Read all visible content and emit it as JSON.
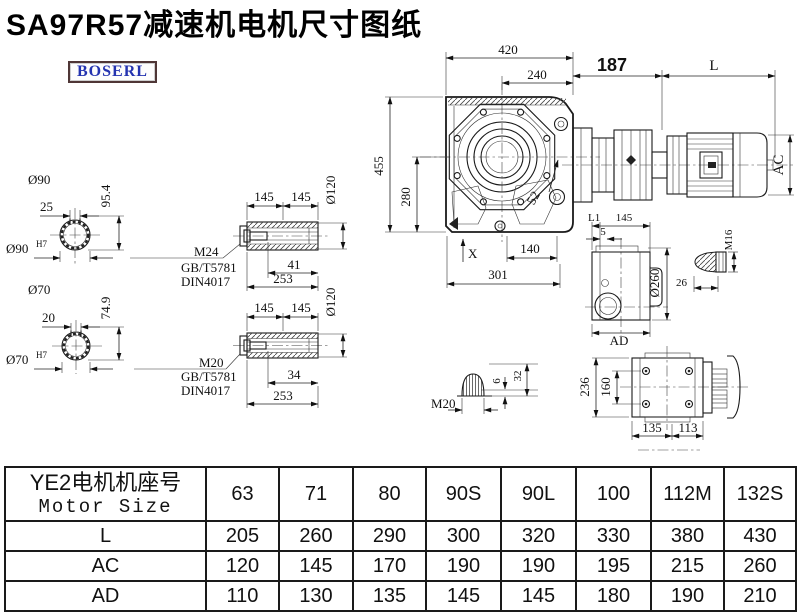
{
  "title": "SA97R57减速机电机尺寸图纸",
  "brand": {
    "logo_text": "BOSERL"
  },
  "colors": {
    "title_text": "#000000",
    "logo_text": "#2433b0",
    "logo_border": "#4f3636",
    "line": "#1a1a1a",
    "background": "#ffffff",
    "table_border": "#1a1a1a"
  },
  "drawing": {
    "front_view": {
      "width_top": "420",
      "width_flange": "240",
      "gear_to_motor": "187",
      "motor_length": "L",
      "height_total": "455",
      "height_center": "280",
      "bolt_offset": "52",
      "foot_width": "140",
      "base_width": "301",
      "oil_mark": "X",
      "motor_diameter": "AC"
    },
    "shaft_upper": {
      "label": "Ø90",
      "key_width": "25",
      "key_height": "95.4",
      "bore": "Ø90",
      "bore_fit": "H7"
    },
    "shaft_lower": {
      "label": "Ø70",
      "key_width": "20",
      "key_height": "74.9",
      "bore": "Ø70",
      "bore_fit": "H7"
    },
    "sleeve_upper": {
      "seg1": "145",
      "seg2": "145",
      "diameter": "Ø120",
      "thread": "M24",
      "standard1": "GB/T5781",
      "standard2": "DIN4017",
      "thread_depth": "41",
      "length": "253"
    },
    "sleeve_lower": {
      "seg1": "145",
      "seg2": "145",
      "diameter": "Ø120",
      "thread": "M20",
      "standard1": "GB/T5781",
      "standard2": "DIN4017",
      "thread_depth": "34",
      "length": "253"
    },
    "side_view": {
      "dim_l1": "L1",
      "dim_145": "145",
      "dim_5": "5",
      "diameter": "Ø260",
      "dim_ad": "AD"
    },
    "bolt_detail": {
      "thread": "M16",
      "length": "26"
    },
    "plug_detail": {
      "thread": "M20",
      "dim_6": "6",
      "dim_32": "32"
    },
    "rear_view": {
      "height": "236",
      "hole_spacing": "160",
      "width_left": "135",
      "width_right": "113"
    }
  },
  "table": {
    "header_cn": "YE2电机机座号",
    "header_en": "Motor Size",
    "columns": [
      "63",
      "71",
      "80",
      "90S",
      "90L",
      "100",
      "112M",
      "132S"
    ],
    "rows": [
      {
        "label": "L",
        "values": [
          "205",
          "260",
          "290",
          "300",
          "320",
          "330",
          "380",
          "430"
        ]
      },
      {
        "label": "AC",
        "values": [
          "120",
          "145",
          "170",
          "190",
          "190",
          "195",
          "215",
          "260"
        ]
      },
      {
        "label": "AD",
        "values": [
          "110",
          "130",
          "135",
          "145",
          "145",
          "180",
          "190",
          "210"
        ]
      }
    ]
  }
}
